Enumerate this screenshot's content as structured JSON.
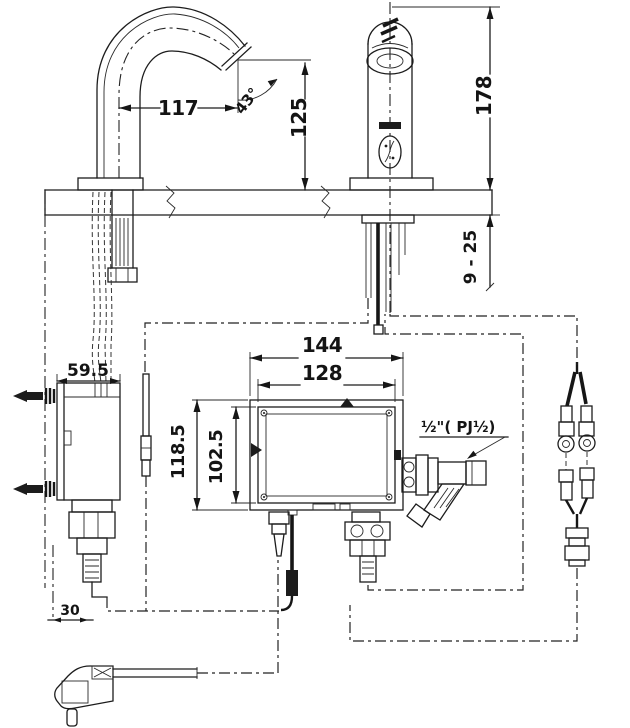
{
  "drawing": {
    "dims": {
      "reach": "117",
      "angle": "43°",
      "outlet_height": "125",
      "total_height": "178",
      "deck_thickness": "9 - 25",
      "box_width": "144",
      "box_inner_width": "128",
      "box_height": "118.5",
      "box_inner_height": "102.5",
      "controller_depth": "59.5",
      "outlet_offset": "30",
      "inlet": "½\"( PJ½)"
    },
    "colors": {
      "line": "#1c1c1c",
      "background": "#ffffff"
    }
  }
}
